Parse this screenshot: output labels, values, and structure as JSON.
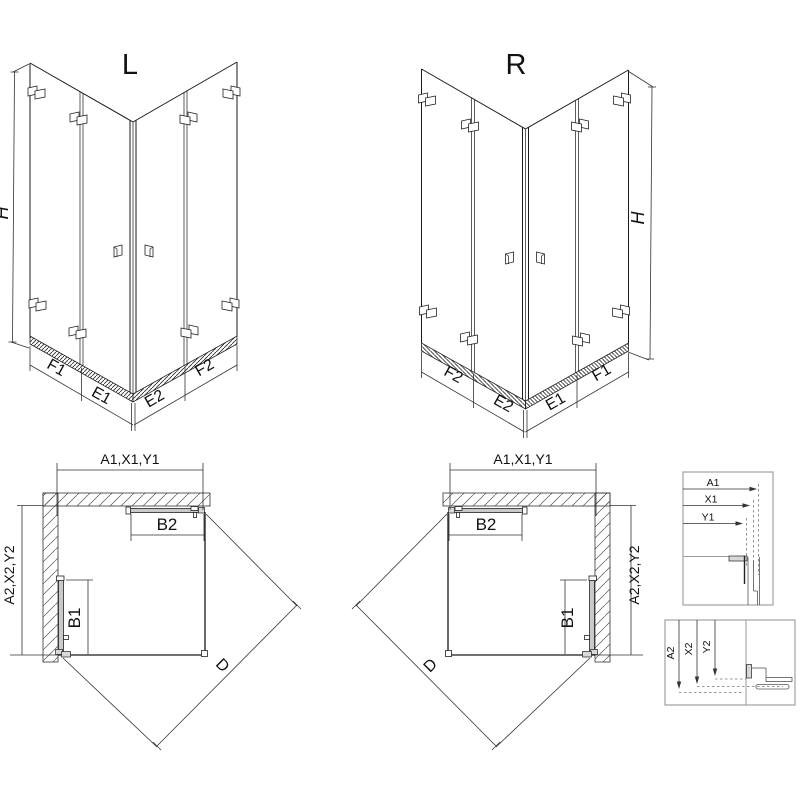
{
  "drawing": {
    "iso_left": {
      "title": "L",
      "height_label": "H",
      "bottom_labels_left": [
        "F1",
        "E1"
      ],
      "bottom_labels_right": [
        "E2",
        "F2"
      ]
    },
    "iso_right": {
      "title": "R",
      "height_label": "H",
      "bottom_labels_left": [
        "F2",
        "E2"
      ],
      "bottom_labels_right": [
        "E1",
        "F1"
      ]
    },
    "plan_left": {
      "width_label": "A1,X1,Y1",
      "depth_label": "A2,X2,Y2",
      "door_top_label": "B2",
      "door_side_label": "B1",
      "diagonal_label": "D"
    },
    "plan_right": {
      "width_label": "A1,X1,Y1",
      "depth_label": "A2,X2,Y2",
      "door_top_label": "B2",
      "door_side_label": "B1",
      "diagonal_label": "D"
    },
    "detail_width": {
      "dims": [
        "A1",
        "X1",
        "Y1"
      ]
    },
    "detail_depth": {
      "dims": [
        "A2",
        "X2",
        "Y2"
      ]
    }
  },
  "colors": {
    "line": "#1a1a1a",
    "dimension": "#333333",
    "panel_border": "#8f8f8f",
    "hatch": "#555555",
    "hardware_fill": "#c9c9c9"
  }
}
